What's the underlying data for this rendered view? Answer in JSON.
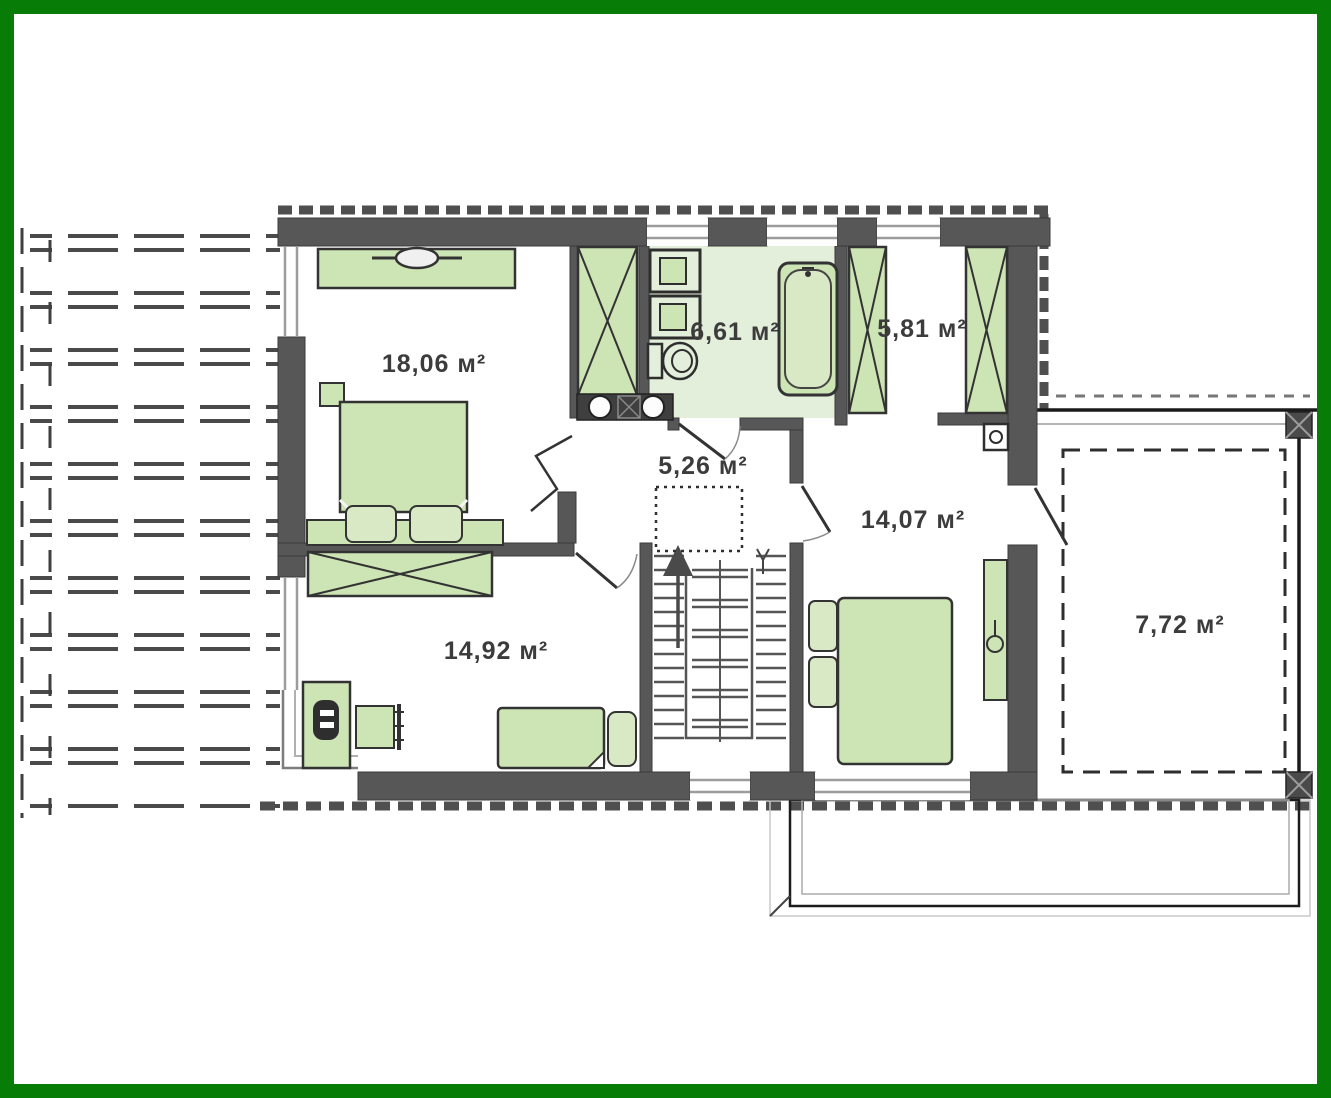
{
  "image": {
    "type": "architectural floor plan, upper storey",
    "frame_color": "#077d07",
    "background": "#ffffff"
  },
  "colors": {
    "wall": "#575757",
    "outline": "#333333",
    "furniture_green": "#cde4b4",
    "furniture_green_light": "#d9e9c6",
    "bathroom_floor": "#e3efda",
    "window_line": "#9c9c9c",
    "hatch": "#4f4f4f"
  },
  "units": "м²",
  "rooms": {
    "bedroom_large": {
      "name": "bedroom-top-left",
      "area_label": "18,06 м²"
    },
    "bathroom": {
      "name": "bathroom",
      "area_label": "6,61 м²"
    },
    "wardrobe": {
      "name": "wardrobe-room",
      "area_label": "5,81 м²"
    },
    "hall": {
      "name": "hall-stairs",
      "area_label": "5,26 м²"
    },
    "bedroom_right": {
      "name": "bedroom-right",
      "area_label": "14,07 м²"
    },
    "bedroom_bottom": {
      "name": "bedroom-bottom",
      "area_label": "14,92 м²"
    },
    "balcony": {
      "name": "balcony",
      "area_label": "7,72 м²"
    }
  }
}
